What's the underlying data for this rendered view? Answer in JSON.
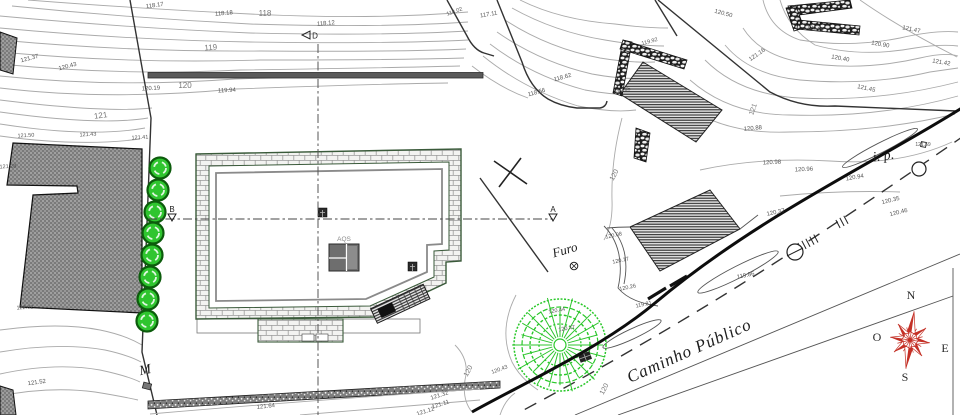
{
  "plan": {
    "road_label": "Caminho Público",
    "furo_label": "Furo",
    "ip_label": "i. p.",
    "aqs_label": "AQS",
    "gate_label": "M",
    "sections": {
      "a": "A",
      "b": "B",
      "d": "D"
    },
    "compass": {
      "n": "N",
      "e": "E",
      "s": "S",
      "o": "O",
      "color": "#c43026"
    },
    "colors": {
      "tree_fill": "#2fc52f",
      "tree_ring": "#0c5c0c",
      "contour": "#aaaaaa",
      "wall_outline": "#3a5a3a",
      "boundary": "#1a1a1a"
    },
    "elevation_labels": [
      {
        "t": "118.17",
        "x": 155,
        "y": 7,
        "r": -8,
        "s": 6
      },
      {
        "t": "118.18",
        "x": 224,
        "y": 15,
        "r": -5,
        "s": 6
      },
      {
        "t": "118",
        "x": 265,
        "y": 16,
        "r": 0,
        "s": 8,
        "m": 1
      },
      {
        "t": "118.12",
        "x": 326,
        "y": 25,
        "r": -5,
        "s": 6
      },
      {
        "t": "119",
        "x": 211,
        "y": 50,
        "r": -5,
        "s": 8,
        "m": 1
      },
      {
        "t": "117.11",
        "x": 489,
        "y": 16,
        "r": -10,
        "s": 6
      },
      {
        "t": "118.02",
        "x": 455,
        "y": 13,
        "r": -20,
        "s": 5.5
      },
      {
        "t": "120.19",
        "x": 151,
        "y": 90,
        "r": -3,
        "s": 6
      },
      {
        "t": "120",
        "x": 185,
        "y": 88,
        "r": 0,
        "s": 8,
        "m": 1
      },
      {
        "t": "119.94",
        "x": 227,
        "y": 92,
        "r": -3,
        "s": 6
      },
      {
        "t": "121.37",
        "x": 30,
        "y": 60,
        "r": -15,
        "s": 6
      },
      {
        "t": "120.43",
        "x": 68,
        "y": 68,
        "r": -15,
        "s": 6
      },
      {
        "t": "121",
        "x": 101,
        "y": 118,
        "r": -8,
        "s": 8,
        "m": 1
      },
      {
        "t": "121.50",
        "x": 26,
        "y": 137,
        "r": -3,
        "s": 5.5
      },
      {
        "t": "121.43",
        "x": 88,
        "y": 136,
        "r": -3,
        "s": 5.5
      },
      {
        "t": "121.41",
        "x": 140,
        "y": 139,
        "r": -3,
        "s": 5.5
      },
      {
        "t": "121.28",
        "x": 8,
        "y": 168,
        "r": -3,
        "s": 5.5
      },
      {
        "t": "122.02",
        "x": 25,
        "y": 309,
        "r": -3,
        "s": 5.5
      },
      {
        "t": "121.52",
        "x": 37,
        "y": 384,
        "r": -8,
        "s": 6
      },
      {
        "t": "118.62",
        "x": 563,
        "y": 79,
        "r": -15,
        "s": 6
      },
      {
        "t": "118.56",
        "x": 537,
        "y": 94,
        "r": -15,
        "s": 6
      },
      {
        "t": "119.92",
        "x": 650,
        "y": 43,
        "r": -15,
        "s": 5.5
      },
      {
        "t": "119.45",
        "x": 623,
        "y": 92,
        "r": -15,
        "s": 5.5
      },
      {
        "t": "120.50",
        "x": 723,
        "y": 15,
        "r": 15,
        "s": 6
      },
      {
        "t": "121.16",
        "x": 758,
        "y": 56,
        "r": -35,
        "s": 6
      },
      {
        "t": "120.40",
        "x": 840,
        "y": 60,
        "r": 10,
        "s": 6
      },
      {
        "t": "121.47",
        "x": 911,
        "y": 31,
        "r": 12,
        "s": 6
      },
      {
        "t": "120.90",
        "x": 880,
        "y": 46,
        "r": 10,
        "s": 6
      },
      {
        "t": "121.45",
        "x": 866,
        "y": 90,
        "r": 12,
        "s": 6
      },
      {
        "t": "121.42",
        "x": 941,
        "y": 64,
        "r": 10,
        "s": 6
      },
      {
        "t": "121",
        "x": 755,
        "y": 110,
        "r": -70,
        "s": 7,
        "m": 1
      },
      {
        "t": "120.88",
        "x": 753,
        "y": 130,
        "r": -5,
        "s": 6
      },
      {
        "t": "120",
        "x": 616,
        "y": 176,
        "r": -62,
        "s": 7,
        "m": 1
      },
      {
        "t": "120.98",
        "x": 772,
        "y": 164,
        "r": -3,
        "s": 6
      },
      {
        "t": "120.96",
        "x": 804,
        "y": 171,
        "r": -3,
        "s": 6
      },
      {
        "t": "120.94",
        "x": 855,
        "y": 179,
        "r": -10,
        "s": 6
      },
      {
        "t": "120.37",
        "x": 776,
        "y": 214,
        "r": -12,
        "s": 6
      },
      {
        "t": "120.35",
        "x": 891,
        "y": 202,
        "r": -14,
        "s": 6
      },
      {
        "t": "120.46",
        "x": 899,
        "y": 214,
        "r": -14,
        "s": 6
      },
      {
        "t": "121.59",
        "x": 923,
        "y": 146,
        "r": 0,
        "s": 5
      },
      {
        "t": "120.08",
        "x": 614,
        "y": 237,
        "r": -12,
        "s": 5.5
      },
      {
        "t": "120.17",
        "x": 621,
        "y": 262,
        "r": -12,
        "s": 5.5
      },
      {
        "t": "120.26",
        "x": 628,
        "y": 289,
        "r": -12,
        "s": 5.5
      },
      {
        "t": "119.81",
        "x": 644,
        "y": 306,
        "r": -12,
        "s": 5.5
      },
      {
        "t": "119.86",
        "x": 746,
        "y": 277,
        "r": -12,
        "s": 6
      },
      {
        "t": "120.44",
        "x": 557,
        "y": 312,
        "r": -10,
        "s": 5.5
      },
      {
        "t": "120.47",
        "x": 567,
        "y": 330,
        "r": -10,
        "s": 5.5
      },
      {
        "t": "120",
        "x": 470,
        "y": 372,
        "r": -62,
        "s": 7,
        "m": 1
      },
      {
        "t": "120",
        "x": 606,
        "y": 390,
        "r": -62,
        "s": 7,
        "m": 1
      },
      {
        "t": "120.43",
        "x": 500,
        "y": 371,
        "r": -20,
        "s": 5.5
      },
      {
        "t": "121.64",
        "x": 266,
        "y": 408,
        "r": -6,
        "s": 6
      },
      {
        "t": "121.32",
        "x": 440,
        "y": 397,
        "r": -18,
        "s": 6
      },
      {
        "t": "121.11",
        "x": 441,
        "y": 406,
        "r": -18,
        "s": 6
      },
      {
        "t": "121.12",
        "x": 426,
        "y": 413,
        "r": -18,
        "s": 6
      },
      {
        "t": "120.99",
        "x": 815,
        "y": 30,
        "r": 10,
        "s": 5.5
      }
    ],
    "trees_small": [
      [
        160,
        168
      ],
      [
        158,
        190
      ],
      [
        155,
        212
      ],
      [
        153,
        233
      ],
      [
        152,
        255
      ],
      [
        150,
        277
      ],
      [
        148,
        299
      ],
      [
        147,
        321
      ]
    ],
    "big_tree": {
      "cx": 560,
      "cy": 345,
      "r": 47
    }
  }
}
